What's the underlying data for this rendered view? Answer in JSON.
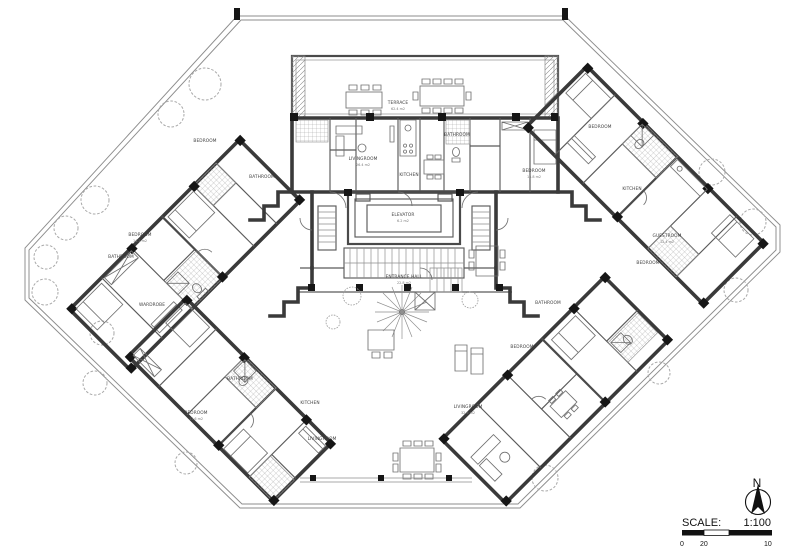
{
  "document": {
    "kind": "architectural floor plan drawing"
  },
  "legend": {
    "north_label": "N",
    "scale_label": "SCALE:",
    "scale_value": "1:100",
    "tick_zero": "0",
    "tick_twenty": "20",
    "tick_ten": "10"
  },
  "colors": {
    "paper": "#ffffff",
    "wall": "#3a3a3a",
    "thin_line": "#8f8f8f",
    "boundary": "#8d8d8d",
    "ink": "#161616"
  },
  "rooms": [
    {
      "label": "TERRACE",
      "area": "62.4 m2"
    },
    {
      "label": "ELEVATOR",
      "area": "6.2 m2"
    },
    {
      "label": "ENTRANCE HALL",
      "area": "22.8 m2"
    },
    {
      "label": "LIVINGROOM",
      "area": "26.4 m2"
    },
    {
      "label": "KITCHEN",
      "area": ""
    },
    {
      "label": "BATHROOM",
      "area": ""
    },
    {
      "label": "BEDROOM",
      "area": "15.8 m2"
    },
    {
      "label": "BEDROOM",
      "area": ""
    },
    {
      "label": "BATHROOM",
      "area": ""
    },
    {
      "label": "BEDROOM",
      "area": "14.2 m2"
    },
    {
      "label": "BATHROOM",
      "area": ""
    },
    {
      "label": "WARDROBE",
      "area": ""
    },
    {
      "label": "BEDROOM",
      "area": "13.6 m2"
    },
    {
      "label": "BATHROOM",
      "area": ""
    },
    {
      "label": "KITCHEN",
      "area": ""
    },
    {
      "label": "LIVINGROOM",
      "area": ""
    },
    {
      "label": "BEDROOM",
      "area": ""
    },
    {
      "label": "KITCHEN",
      "area": ""
    },
    {
      "label": "GUESTROOM",
      "area": "12.4 m2"
    },
    {
      "label": "BEDROOM",
      "area": ""
    },
    {
      "label": "LIVINGROOM",
      "area": "32.6 m2"
    },
    {
      "label": "BEDROOM",
      "area": ""
    },
    {
      "label": "BATHROOM",
      "area": ""
    }
  ]
}
